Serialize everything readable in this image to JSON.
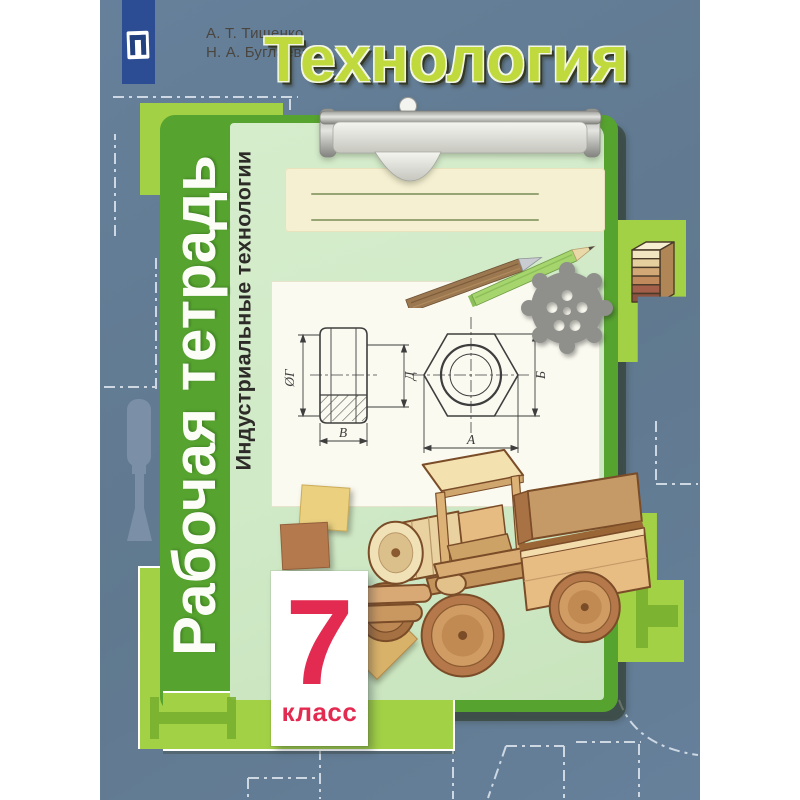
{
  "cover": {
    "authors": [
      "А. Т. Тищенко",
      "Н. А. Буглаева"
    ],
    "title": "Технология",
    "series": "Рабочая тетрадь",
    "subtitle": "Индустриальные технологии",
    "grade": {
      "number": "7",
      "word": "класс"
    }
  },
  "drawing": {
    "labels": {
      "diameter": "ØГ",
      "height": "Д",
      "width": "В",
      "across_corners": "Б",
      "across_flats": "А"
    }
  },
  "icons": {
    "publisher_logo": "prosveshchenie-book-emblem",
    "clip": "clipboard-clip",
    "ornament": "metal-lace-ornament",
    "pencils": "two-pencils",
    "truck": "wooden-toy-truck",
    "wood_stack": "layered-wood-stack",
    "chisel": "chisel-silhouette"
  },
  "colors": {
    "cover-blue": "#66809b",
    "lime": "#a2d145",
    "board-green": "#57a32f",
    "clip-green": "#cfe9c6",
    "cream": "#f6f0d2",
    "paper-white": "#fbfaf0",
    "title-lime": "#c0d93c",
    "red": "#e32a50",
    "logo-blue": "#2c4c94",
    "dash": "#d9e2ec"
  }
}
